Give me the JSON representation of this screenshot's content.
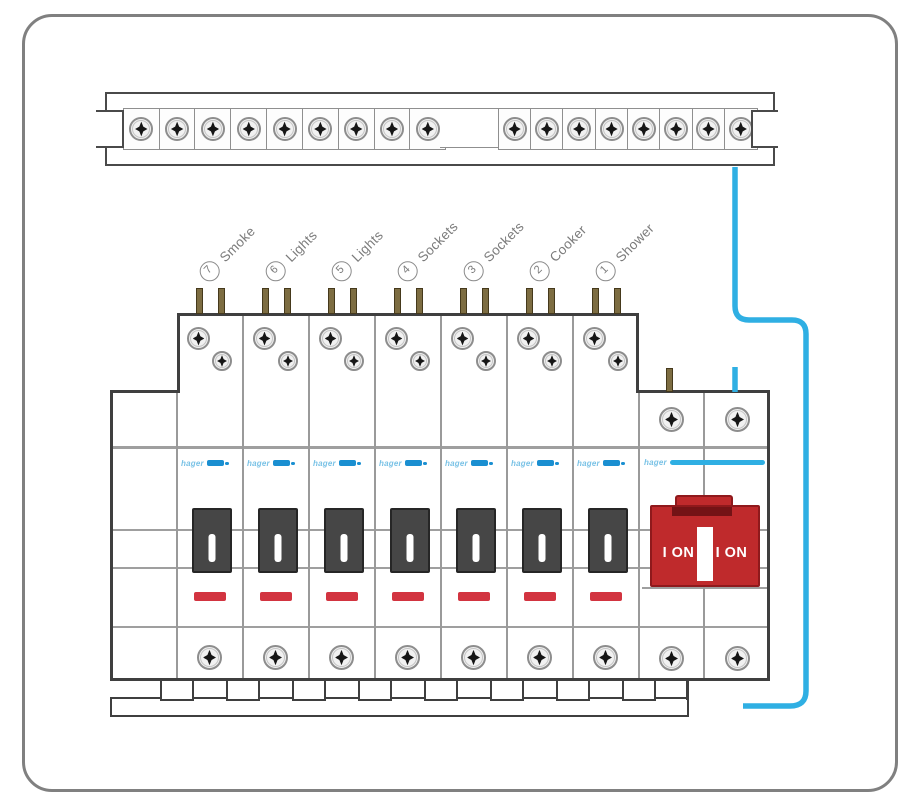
{
  "brand": "hager",
  "circuits": [
    {
      "number": "7",
      "name": "Smoke"
    },
    {
      "number": "6",
      "name": "Lights"
    },
    {
      "number": "5",
      "name": "Lights"
    },
    {
      "number": "4",
      "name": "Sockets"
    },
    {
      "number": "3",
      "name": "Sockets"
    },
    {
      "number": "2",
      "name": "Cooker"
    },
    {
      "number": "1",
      "name": "Shower"
    }
  ],
  "main_switch": {
    "labels": [
      "I ON",
      "I ON"
    ]
  },
  "terminal_strip": {
    "left_screw_count": 9,
    "right_screw_count": 8
  },
  "colors": {
    "wire_blue": "#2fafe3",
    "brand_blue": "#1a8fd1",
    "switch_red": "#bf2a2c",
    "rating_bar_red": "#d23440",
    "toggle_dark": "#464646",
    "outline_dark": "#3f3f3f",
    "label_gray": "#7b7b7b"
  }
}
